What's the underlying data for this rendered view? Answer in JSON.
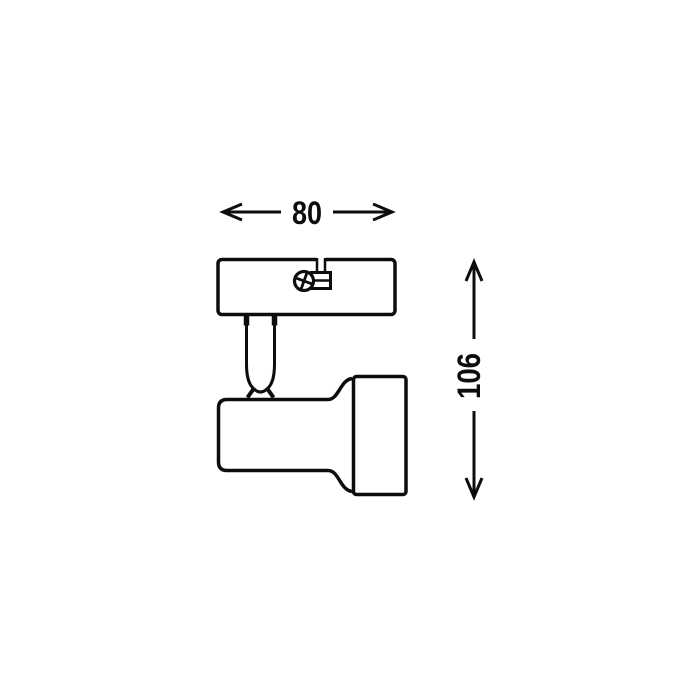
{
  "page": {
    "background_color": "#ffffff"
  },
  "diagram": {
    "type": "technical-dimension-drawing",
    "line_color": "#0d0d0d",
    "dimensions": {
      "width": {
        "label": "80"
      },
      "height": {
        "label": "106"
      }
    },
    "parts": [
      "mounting-plate",
      "cable-slot",
      "cable-clamp",
      "fixing-screw",
      "swivel-stem",
      "swivel-joint",
      "lamp-head-body",
      "lamp-head-ring"
    ]
  }
}
